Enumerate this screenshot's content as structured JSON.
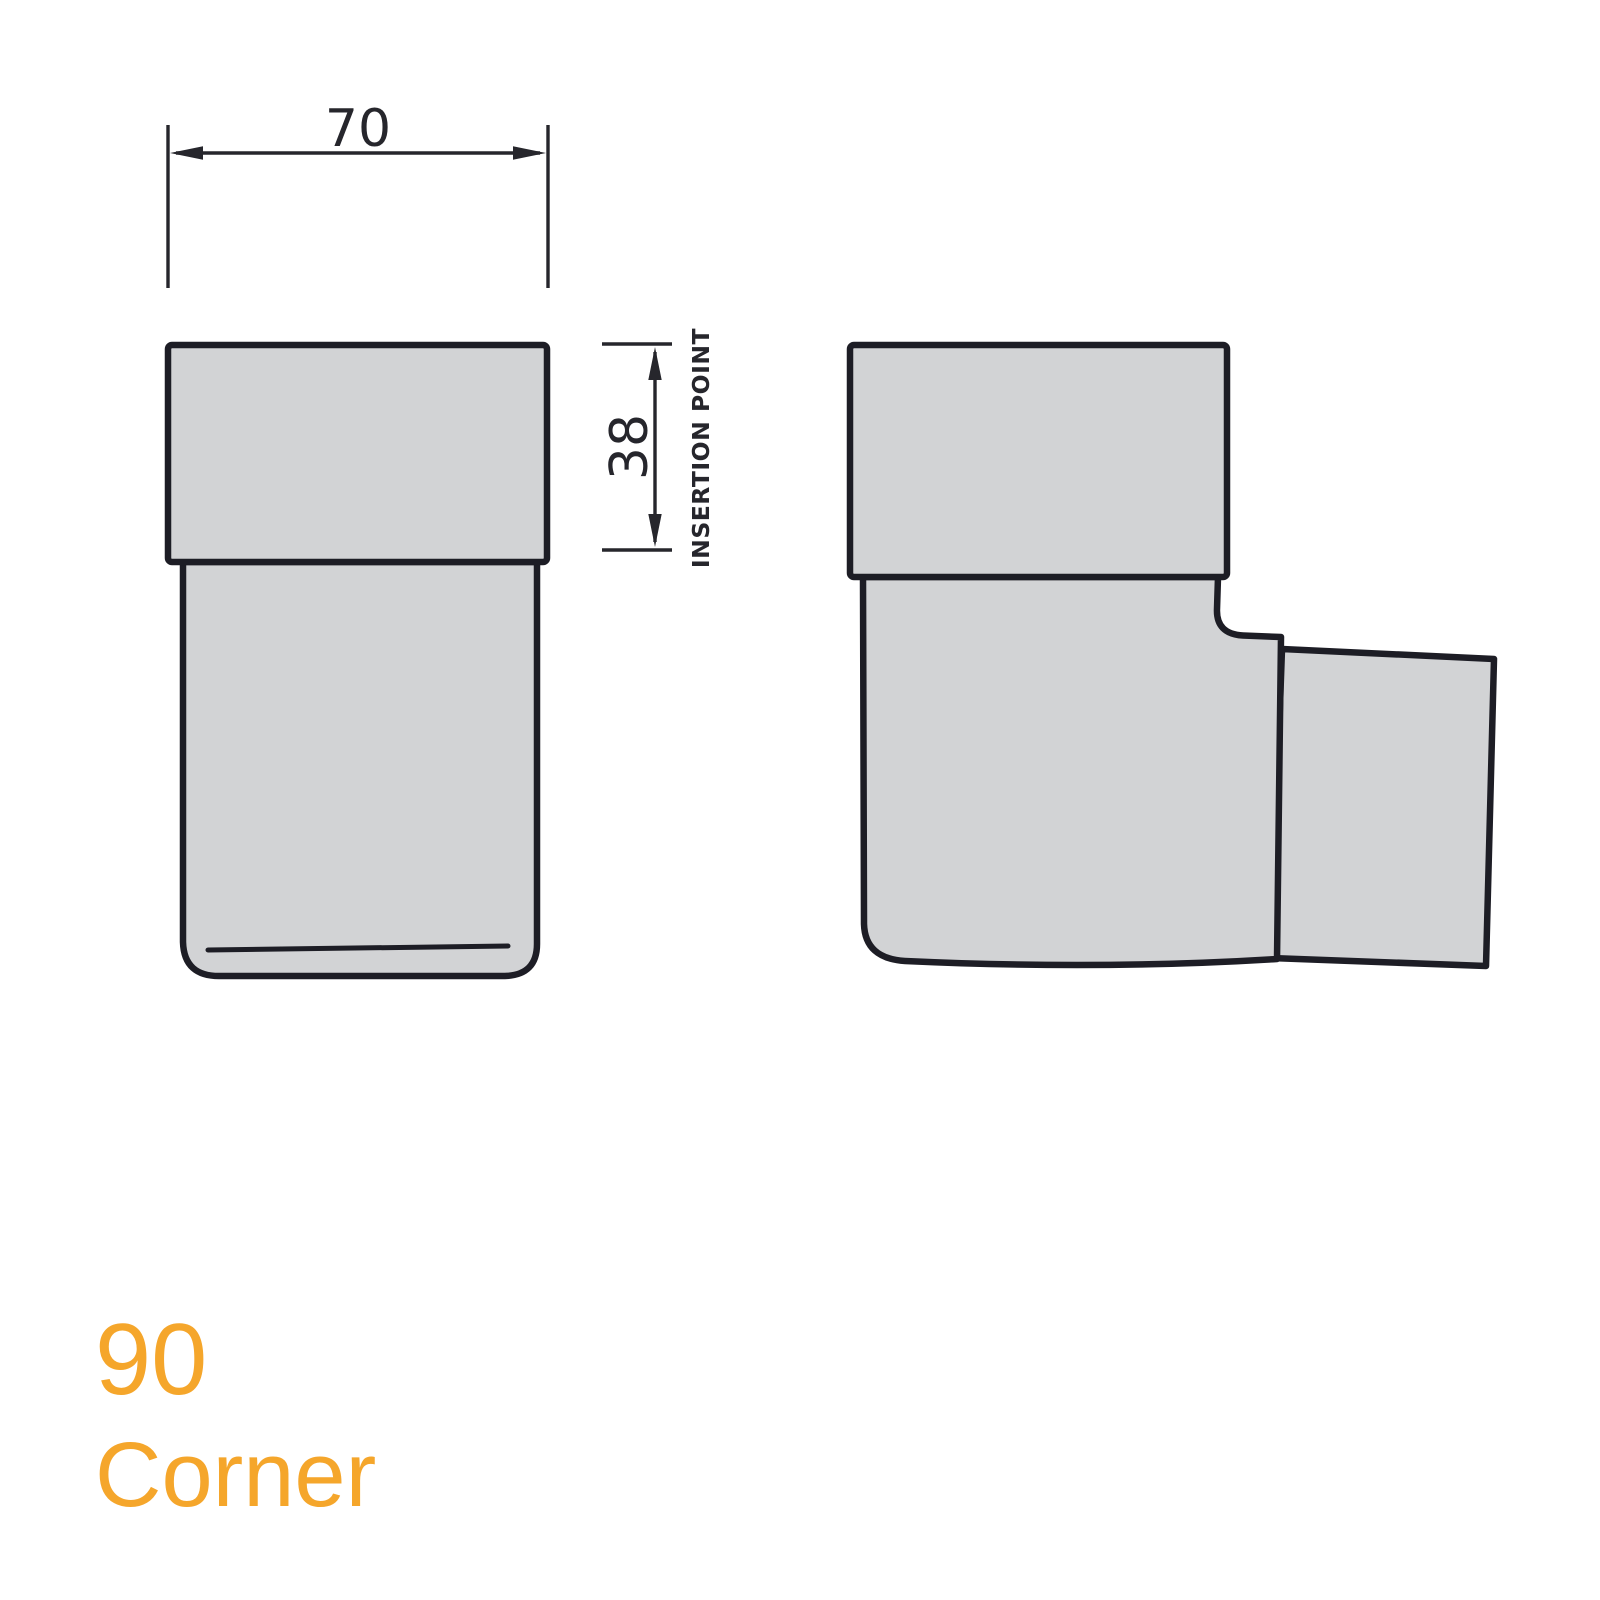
{
  "colors": {
    "outline": "#1d1d25",
    "dimension": "#26262c",
    "fill": "#d2d3d5",
    "accent": "#f5a62b",
    "background": "#ffffff"
  },
  "drawing": {
    "type": "technical-drawing",
    "views": {
      "front_view": "front elevation of 90 corner fitting",
      "side_view": "side elevation of 90 corner fitting with outlet"
    },
    "dimensions": {
      "width": {
        "value": "70"
      },
      "insertion_depth": {
        "value": "38",
        "label": "INSERTION POINT"
      }
    },
    "title": {
      "line1": "90",
      "line2": "Corner"
    }
  }
}
